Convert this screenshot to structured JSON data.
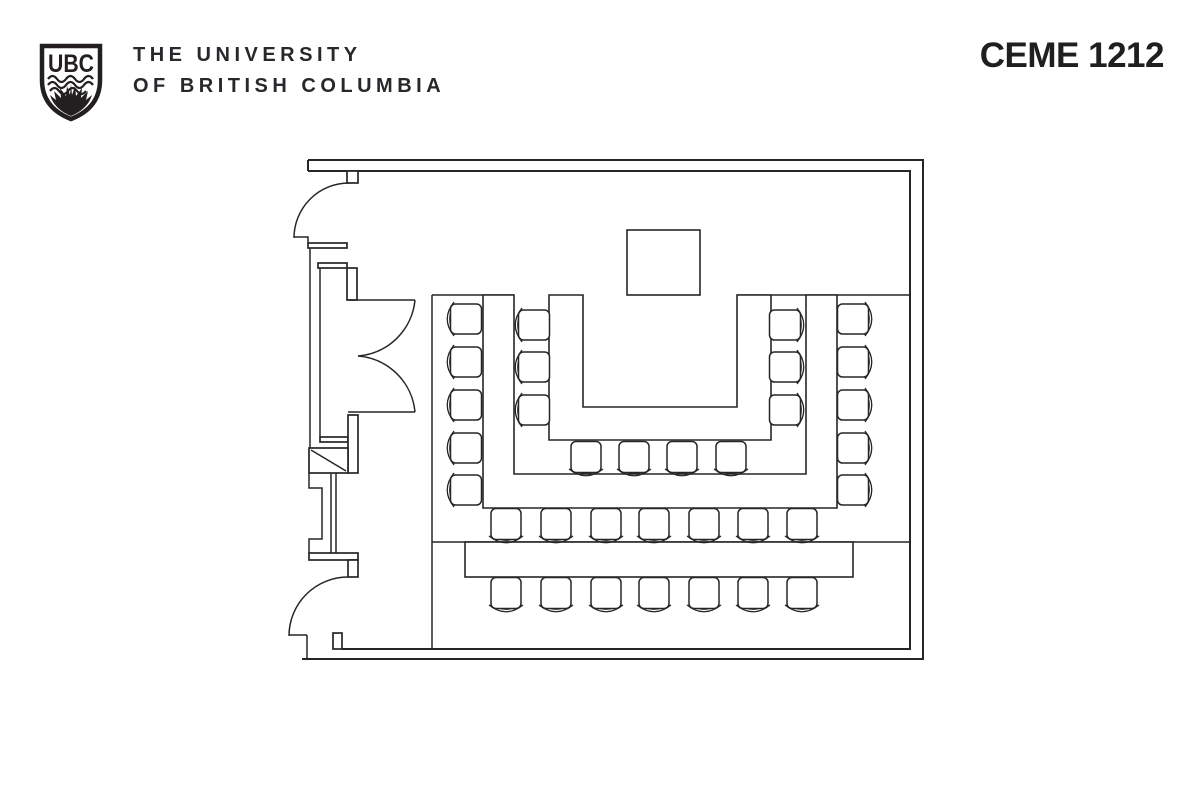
{
  "header": {
    "logo_acronym": "UBC",
    "wordmark_line1": "THE UNIVERSITY",
    "wordmark_line2": "OF BRITISH COLUMBIA",
    "room_label": "CEME 1212"
  },
  "colors": {
    "ink": "#262626",
    "logo_ink": "#231f20",
    "background": "#ffffff"
  },
  "floorplan": {
    "podium": {
      "name": "podium",
      "x": 627,
      "y": 230,
      "w": 73,
      "h": 65
    },
    "tables": [
      {
        "name": "outer-u-table",
        "path": "M483,295 L483,508 L837,508 L837,295 L806,295 L806,474 L514,474 L514,295 Z"
      },
      {
        "name": "inner-u-table",
        "path": "M549,295 L549,440 L771,440 L771,295 L737,295 L737,407 L583,407 L583,295 Z"
      },
      {
        "name": "back-table",
        "x": 465,
        "y": 542,
        "w": 388,
        "h": 35
      }
    ],
    "chair_groups": [
      {
        "name": "left-outer-column",
        "rotation": 90,
        "cx": 466,
        "cys": [
          319,
          362,
          405,
          448,
          490
        ]
      },
      {
        "name": "left-inner-column",
        "rotation": 90,
        "cx": 534,
        "cys": [
          325,
          367,
          410
        ]
      },
      {
        "name": "right-inner-column",
        "rotation": -90,
        "cx": 785,
        "cys": [
          325,
          367,
          410
        ]
      },
      {
        "name": "right-outer-column",
        "rotation": -90,
        "cx": 853,
        "cys": [
          319,
          362,
          405,
          448,
          490
        ]
      },
      {
        "name": "inner-bottom-row",
        "rotation": 0,
        "cy": 457,
        "cxs": [
          586,
          634,
          682,
          731
        ]
      },
      {
        "name": "middle-row",
        "rotation": 0,
        "cy": 524,
        "cxs": [
          506,
          556,
          606,
          654,
          704,
          753,
          802
        ]
      },
      {
        "name": "back-row",
        "rotation": 0,
        "cy": 593,
        "cxs": [
          506,
          556,
          606,
          654,
          704,
          753,
          802
        ]
      }
    ]
  }
}
